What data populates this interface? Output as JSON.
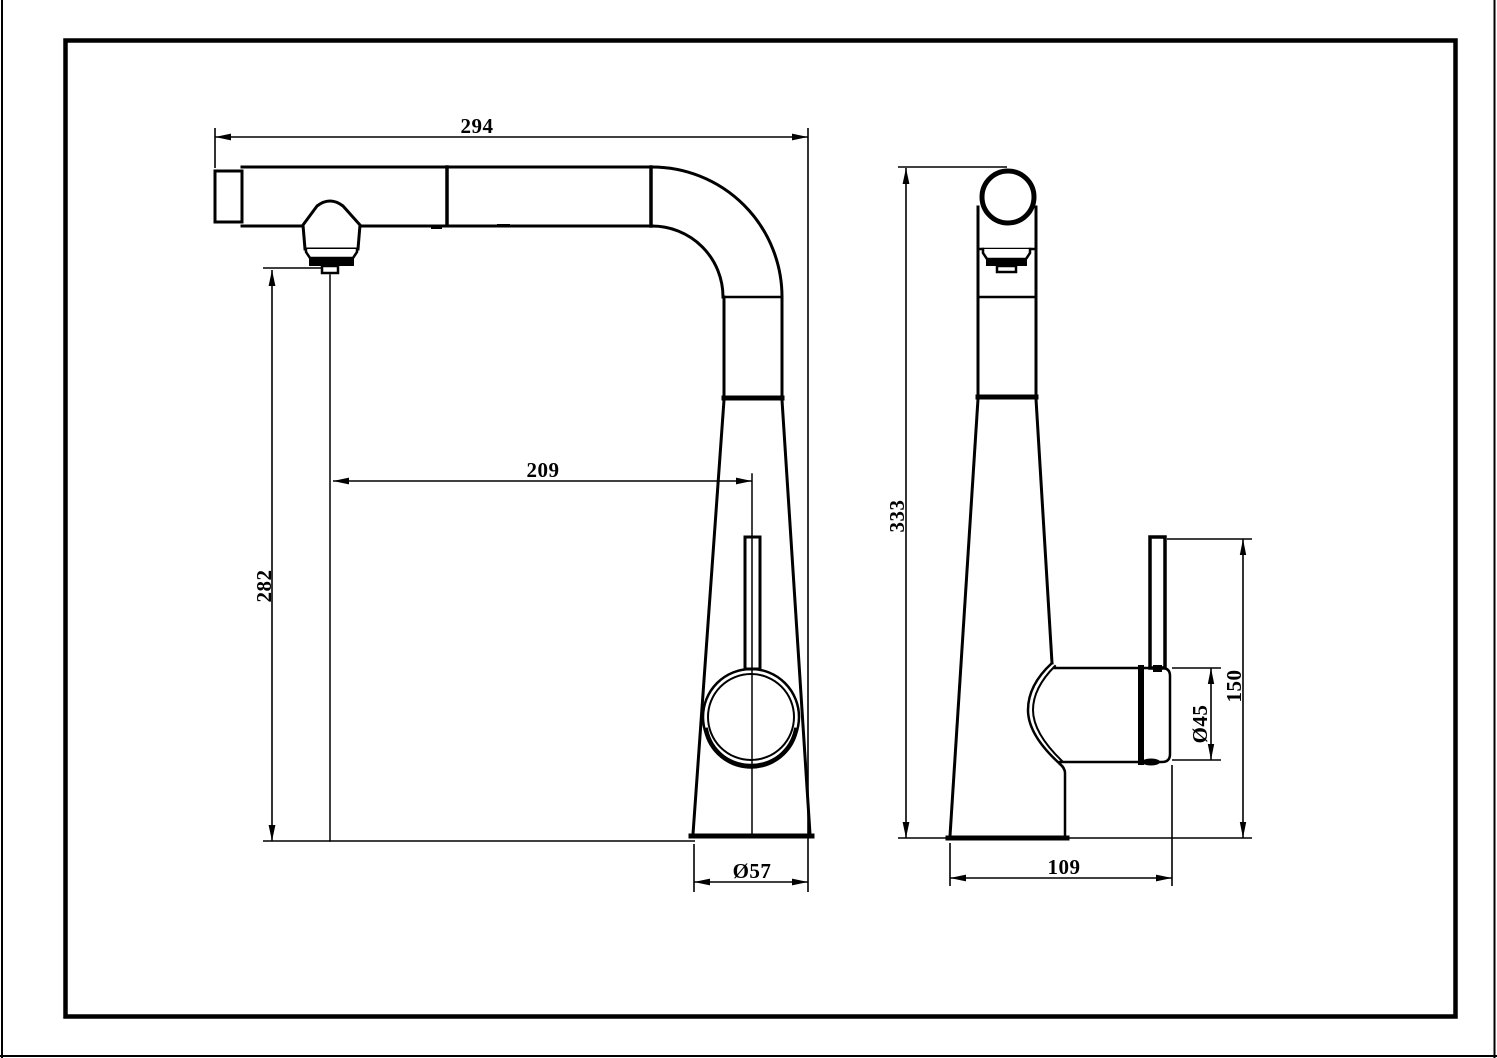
{
  "drawing": {
    "colors": {
      "line": "#000000",
      "background": "#ffffff"
    },
    "front_view": {
      "dim_spout_reach": "294",
      "dim_spout_projection": "209",
      "dim_spout_outlet_height": "282",
      "dim_base_diameter": "Ø57"
    },
    "side_view": {
      "dim_overall_height": "333",
      "dim_base_depth": "109",
      "dim_handle_hub_diameter": "Ø45",
      "dim_handle_top_height": "150"
    }
  }
}
